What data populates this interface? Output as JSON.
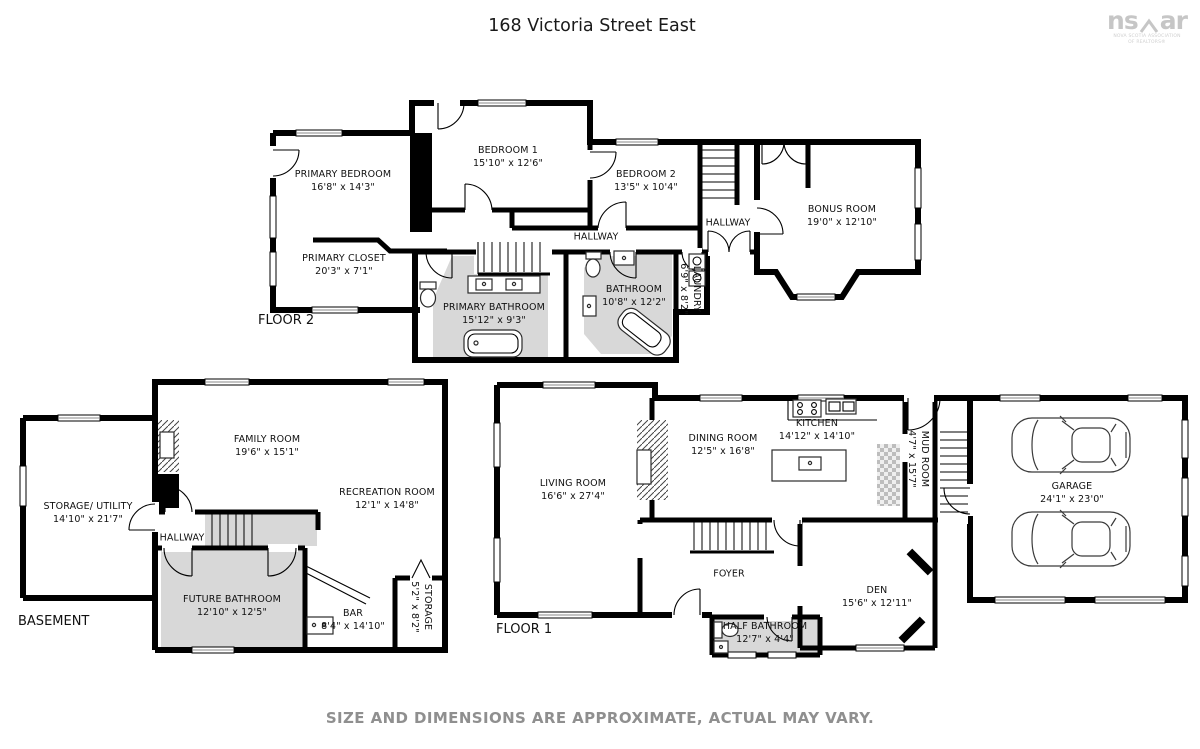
{
  "title": "168 Victoria Street East",
  "logo": {
    "part1": "ns",
    "part2": "ar",
    "sub1": "NOVA SCOTIA ASSOCIATION",
    "sub2": "OF REALTORS®"
  },
  "disclaimer": "SIZE AND DIMENSIONS ARE APPROXIMATE, ACTUAL MAY VARY.",
  "floor2": {
    "label": "FLOOR 2",
    "rooms": {
      "primary_bedroom": {
        "name": "PRIMARY BEDROOM",
        "dims": "16'8\" x 14'3\""
      },
      "bedroom_1": {
        "name": "BEDROOM 1",
        "dims": "15'10\" x 12'6\""
      },
      "bedroom_2": {
        "name": "BEDROOM 2",
        "dims": "13'5\" x 10'4\""
      },
      "bonus_room": {
        "name": "BONUS ROOM",
        "dims": "19'0\" x 12'10\""
      },
      "primary_closet": {
        "name": "PRIMARY CLOSET",
        "dims": "20'3\" x 7'1\""
      },
      "hallway": {
        "name": "HALLWAY"
      },
      "hallway_2": {
        "name": "HALLWAY"
      },
      "primary_bathroom": {
        "name": "PRIMARY BATHROOM",
        "dims": "15'12\" x 9'3\""
      },
      "bathroom": {
        "name": "BATHROOM",
        "dims": "10'8\" x 12'2\""
      },
      "laundry": {
        "name": "LAUNDRY",
        "dims": "6'9\" x 8'2\""
      }
    }
  },
  "basement": {
    "label": "BASEMENT",
    "rooms": {
      "storage_utility": {
        "name": "STORAGE/ UTILITY",
        "dims": "14'10\" x 21'7\""
      },
      "family_room": {
        "name": "FAMILY ROOM",
        "dims": "19'6\" x 15'1\""
      },
      "recreation_room": {
        "name": "RECREATION ROOM",
        "dims": "12'1\" x 14'8\""
      },
      "hallway": {
        "name": "HALLWAY"
      },
      "future_bathroom": {
        "name": "FUTURE BATHROOM",
        "dims": "12'10\" x 12'5\""
      },
      "bar": {
        "name": "BAR",
        "dims": "8'4\" x 14'10\""
      },
      "storage": {
        "name": "STORAGE",
        "dims": "5'2\" x 8'2\""
      }
    }
  },
  "floor1": {
    "label": "FLOOR 1",
    "rooms": {
      "living_room": {
        "name": "LIVING ROOM",
        "dims": "16'6\" x 27'4\""
      },
      "dining_room": {
        "name": "DINING ROOM",
        "dims": "12'5\" x 16'8\""
      },
      "kitchen": {
        "name": "KITCHEN",
        "dims": "14'12\" x 14'10\""
      },
      "mud_room": {
        "name": "MUD ROOM",
        "dims": "4'7\" x 15'7\""
      },
      "garage": {
        "name": "GARAGE",
        "dims": "24'1\" x 23'0\""
      },
      "foyer": {
        "name": "FOYER"
      },
      "den": {
        "name": "DEN",
        "dims": "15'6\" x 12'11\""
      },
      "half_bathroom": {
        "name": "HALF BATHROOM",
        "dims": "12'7\" x 4'4\""
      }
    }
  }
}
